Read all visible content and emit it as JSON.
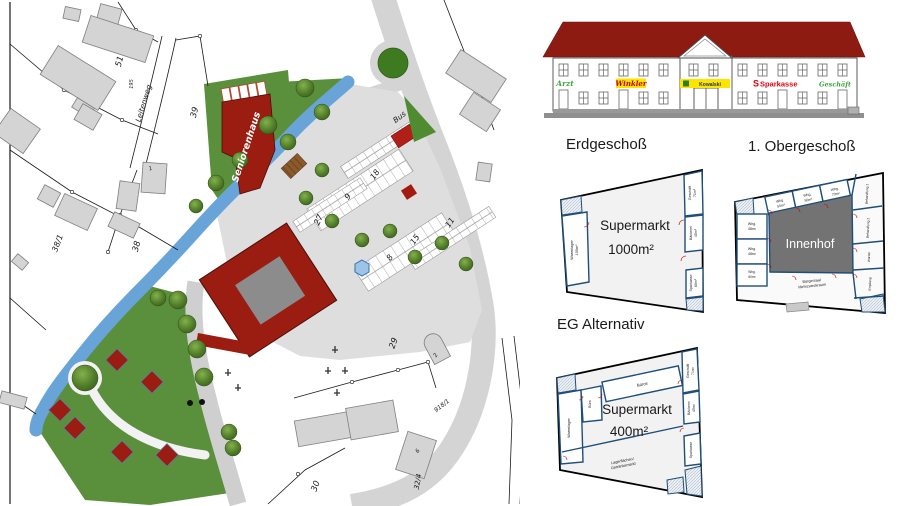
{
  "site": {
    "street_label": "Leitenweg",
    "building_labels": {
      "seniorenhaus": "Seniorenhaus",
      "bus": "Bus"
    },
    "parcel_labels": {
      "p51": "51",
      "p39": "39",
      "p38": "38",
      "p38_1": "38/1",
      "p195": "195",
      "p27": "27",
      "p18": "18",
      "p9": "9",
      "p8": "8",
      "p15": "15",
      "p11": "11",
      "p29": "29",
      "p30": "30",
      "p32_4": "32/4",
      "p918_1": "918/1",
      "h1": "1",
      "h2": "2",
      "h6": "6"
    },
    "colors": {
      "existing_building": "#d4d4d4",
      "new_building": "#9b1c10",
      "green": "#5a8f3c",
      "water": "#69a4d9",
      "road": "#d4d4d4"
    }
  },
  "elevation": {
    "signs": {
      "arzt": "Arzt",
      "winkler": "Winkler",
      "kowalski": "Kowalski",
      "sparkasse_logo": "S",
      "sparkasse": "Sparkasse",
      "geschaeft": "Geschäft"
    },
    "colors": {
      "roof": "#8e1b12",
      "sign_yellow": "#ffe400",
      "sparkasse_red": "#e3000f",
      "shop_green": "#3da53d"
    }
  },
  "floorplans": {
    "eg": {
      "title": "Erdgeschoß",
      "supermarkt_line1": "Supermarkt",
      "supermarkt_line2": "1000m²",
      "warenlager_line1": "Warenlager",
      "warenlager_line2": "100m²",
      "geschaeft_line1": "Geschäft",
      "geschaeft_line2": "71m²",
      "baeckerei_line1": "Bäckerei",
      "baeckerei_line2": "45m²",
      "sparkasse_line1": "Sparkasse",
      "sparkasse_line2": "60m²"
    },
    "og": {
      "title": "1. Obergeschoß",
      "innenhof": "Innenhof",
      "top_rooms": [
        {
          "l1": "Whg.",
          "l2": "50m²"
        },
        {
          "l1": "Whg.",
          "l2": "50m²"
        },
        {
          "l1": "Whg.",
          "l2": "70m²"
        }
      ],
      "left_rooms": [
        {
          "l1": "Whg.",
          "l2": "48m²"
        },
        {
          "l1": "Whg.",
          "l2": "48m²"
        },
        {
          "l1": "Whg.",
          "l2": "60m²"
        }
      ],
      "right_rooms": [
        "Behandlung 1",
        "Behandlung 2",
        "Warten",
        "Empfang"
      ],
      "saal_line1": "Bürgersaal",
      "saal_line2": "Mehrzweckraum"
    },
    "alt": {
      "title": "EG Alternativ",
      "supermarkt_line1": "Supermarkt",
      "supermarkt_line2": "400m²",
      "warenlager": "Warenlager",
      "buero": "Büro",
      "bueros": "Büros",
      "lager_line1": "Lagerflächen/",
      "lager_line2": "Getränkemarkt",
      "geschaeft_line1": "Geschäft",
      "geschaeft_line2": "71m²",
      "baeckerei_line1": "Bäckerei",
      "baeckerei_line2": "45m²",
      "sparkasse": "Sparkasse"
    }
  }
}
